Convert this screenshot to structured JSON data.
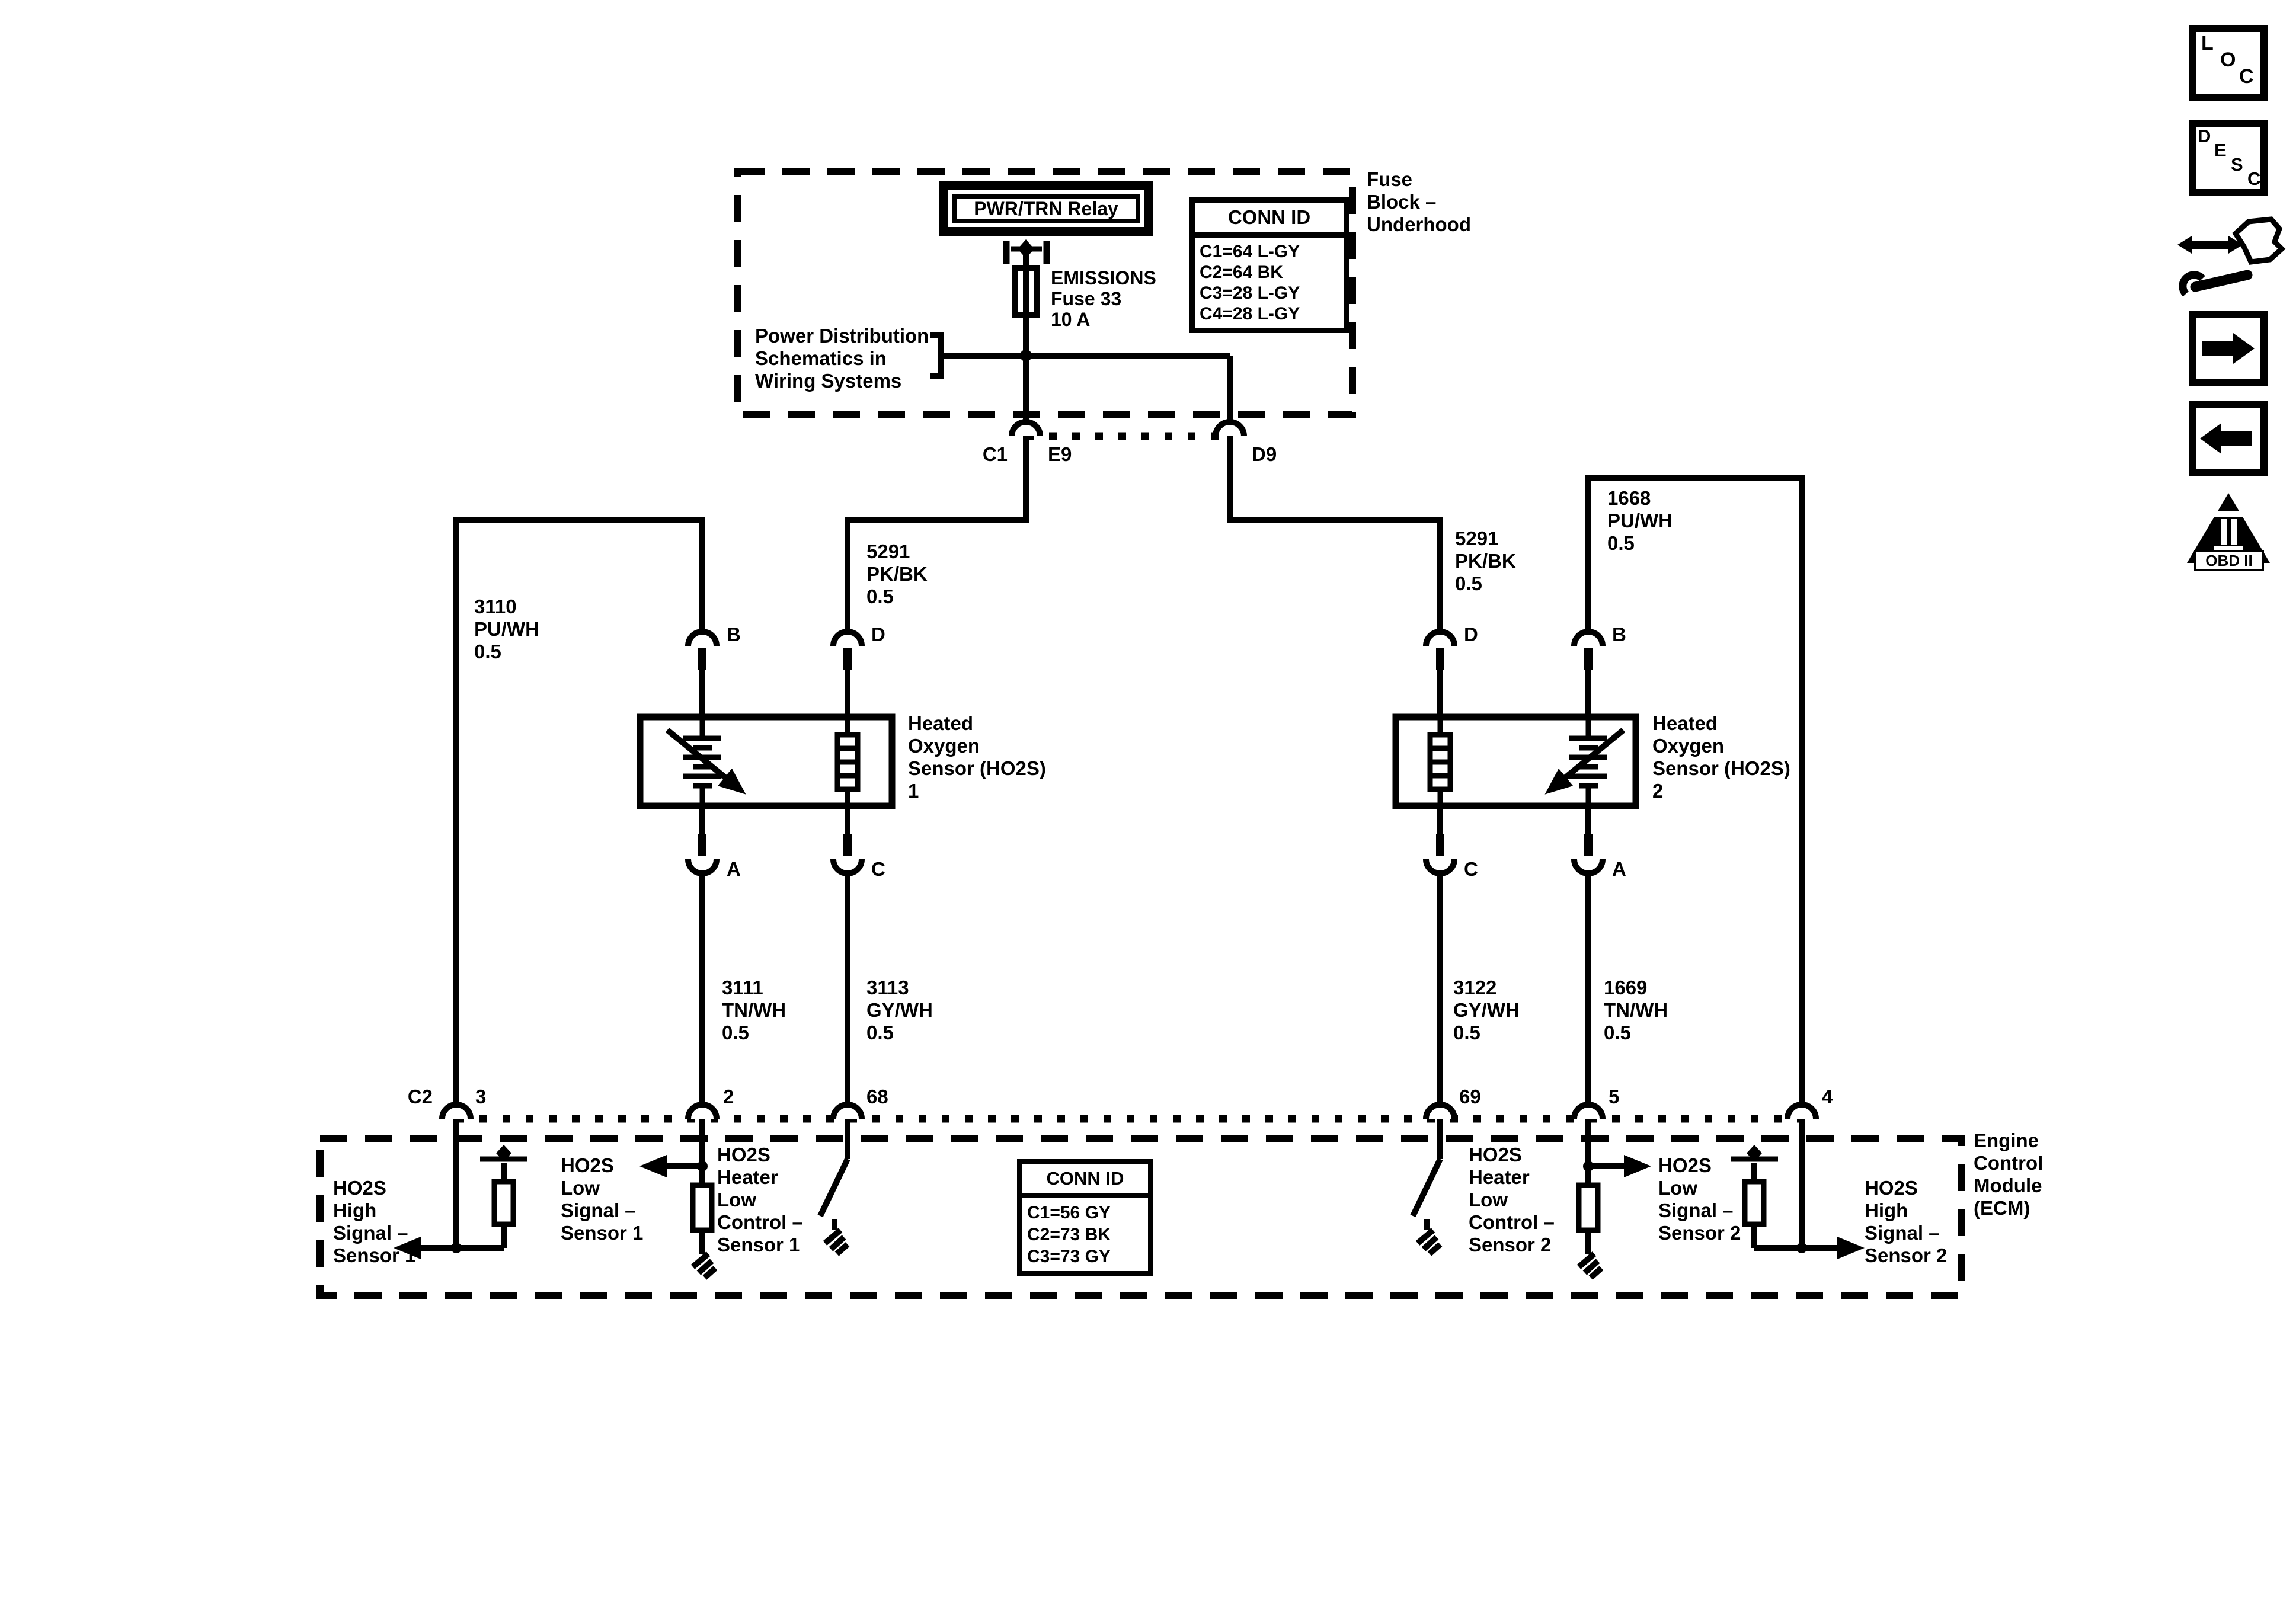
{
  "fuse_block": {
    "relay_label": "PWR/TRN Relay",
    "fuse_label_lines": [
      "EMISSIONS",
      "Fuse 33",
      "10 A"
    ],
    "conn_id_table": {
      "header": "CONN ID",
      "rows": [
        "C1=64 L-GY",
        "C2=64 BK",
        "C3=28 L-GY",
        "C4=28 L-GY"
      ]
    },
    "block_label_lines": [
      "Fuse",
      "Block –",
      "Underhood"
    ],
    "power_distribution_lines": [
      "Power Distribution",
      "Schematics in",
      "Wiring Systems"
    ],
    "connector_c1": "C1",
    "connector_e9": "E9",
    "connector_d9": "D9"
  },
  "wires": {
    "w3110": [
      "3110",
      "PU/WH",
      "0.5"
    ],
    "w5291_left": [
      "5291",
      "PK/BK",
      "0.5"
    ],
    "w5291_right": [
      "5291",
      "PK/BK",
      "0.5"
    ],
    "w1668": [
      "1668",
      "PU/WH",
      "0.5"
    ],
    "w3111": [
      "3111",
      "TN/WH",
      "0.5"
    ],
    "w3113": [
      "3113",
      "GY/WH",
      "0.5"
    ],
    "w3122": [
      "3122",
      "GY/WH",
      "0.5"
    ],
    "w1669": [
      "1669",
      "TN/WH",
      "0.5"
    ]
  },
  "sensor1": {
    "label_lines": [
      "Heated",
      "Oxygen",
      "Sensor (HO2S)",
      "1"
    ],
    "terminals": {
      "in_left": "B",
      "in_right": "D",
      "out_left": "A",
      "out_right": "C"
    }
  },
  "sensor2": {
    "label_lines": [
      "Heated",
      "Oxygen",
      "Sensor (HO2S)",
      "2"
    ],
    "terminals": {
      "in_left": "D",
      "in_right": "B",
      "out_left": "C",
      "out_right": "A"
    }
  },
  "ecm": {
    "label_lines": [
      "Engine",
      "Control",
      "Module",
      "(ECM)"
    ],
    "connector_label": "C2",
    "pins": {
      "p3": "3",
      "p2": "2",
      "p68": "68",
      "p69": "69",
      "p5": "5",
      "p4": "4"
    },
    "conn_id_table": {
      "header": "CONN ID",
      "rows": [
        "C1=56 GY",
        "C2=73 BK",
        "C3=73 GY"
      ]
    },
    "high1_lines": [
      "HO2S",
      "High",
      "Signal –",
      "Sensor 1"
    ],
    "low1_lines": [
      "HO2S",
      "Low",
      "Signal –",
      "Sensor 1"
    ],
    "heater1_lines": [
      "HO2S",
      "Heater",
      "Low",
      "Control –",
      "Sensor 1"
    ],
    "heater2_lines": [
      "HO2S",
      "Heater",
      "Low",
      "Control –",
      "Sensor 2"
    ],
    "low2_lines": [
      "HO2S",
      "Low",
      "Signal –",
      "Sensor 2"
    ],
    "high2_lines": [
      "HO2S",
      "High",
      "Signal –",
      "Sensor 2"
    ]
  },
  "sidebar": {
    "loc_letters": [
      "L",
      "O",
      "C"
    ],
    "desc_letters": [
      "D",
      "E",
      "S",
      "C"
    ],
    "obd_label": "OBD II"
  },
  "colors": {
    "ink": "#000000",
    "paper": "#ffffff"
  }
}
